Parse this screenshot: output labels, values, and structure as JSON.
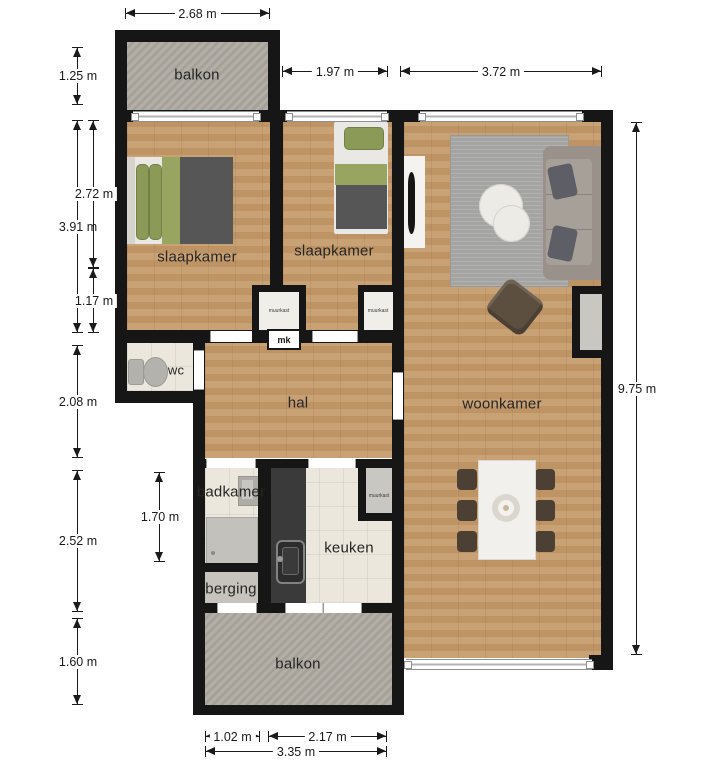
{
  "floorplan": {
    "rooms": {
      "balcony_top": "balkon",
      "bedroom_left": "slaapkamer",
      "bedroom_middle": "slaapkamer",
      "living_room": "woonkamer",
      "toilet": "wc",
      "hall": "hal",
      "bathroom": "badkamer",
      "kitchen": "keuken",
      "storage": "berging",
      "balcony_bottom": "balkon"
    },
    "closets": {
      "wall_closet_left": "muurkast",
      "wall_closet_right": "muurkast",
      "wall_closet_kitchen": "muurkast",
      "meter_cabinet": "mk"
    },
    "dimensions": {
      "top": {
        "balcony": "2.68 m",
        "bedroom2": "1.97 m",
        "living": "3.72 m"
      },
      "left": {
        "balcony": "1.25 m",
        "bedroom1_total": "3.91 m",
        "bedroom1_upper": "2.72 m",
        "bedroom1_lower": "1.17 m",
        "hall": "2.08 m",
        "bath_storage": "2.52 m",
        "balcony_bottom": "1.60 m"
      },
      "inner": {
        "bathroom": "1.70 m"
      },
      "right": {
        "total": "9.75 m"
      },
      "bottom": {
        "storage": "1.02 m",
        "kitchen": "2.17 m",
        "balcony": "3.35 m"
      }
    },
    "colors": {
      "wall": "#161616",
      "wood_floor": "#c49a6b",
      "tile_floor": "#ebe7dd",
      "concrete_floor": "#aeaaa2",
      "bed_green": "#8b9b57",
      "blanket_gray": "#565656",
      "counter_dark": "#3a3a3a",
      "rug_gray": "#a4a4a3",
      "sofa_taupe": "#99918a",
      "chair_brown": "#4c4034",
      "table_white": "#f2f0ec"
    }
  }
}
